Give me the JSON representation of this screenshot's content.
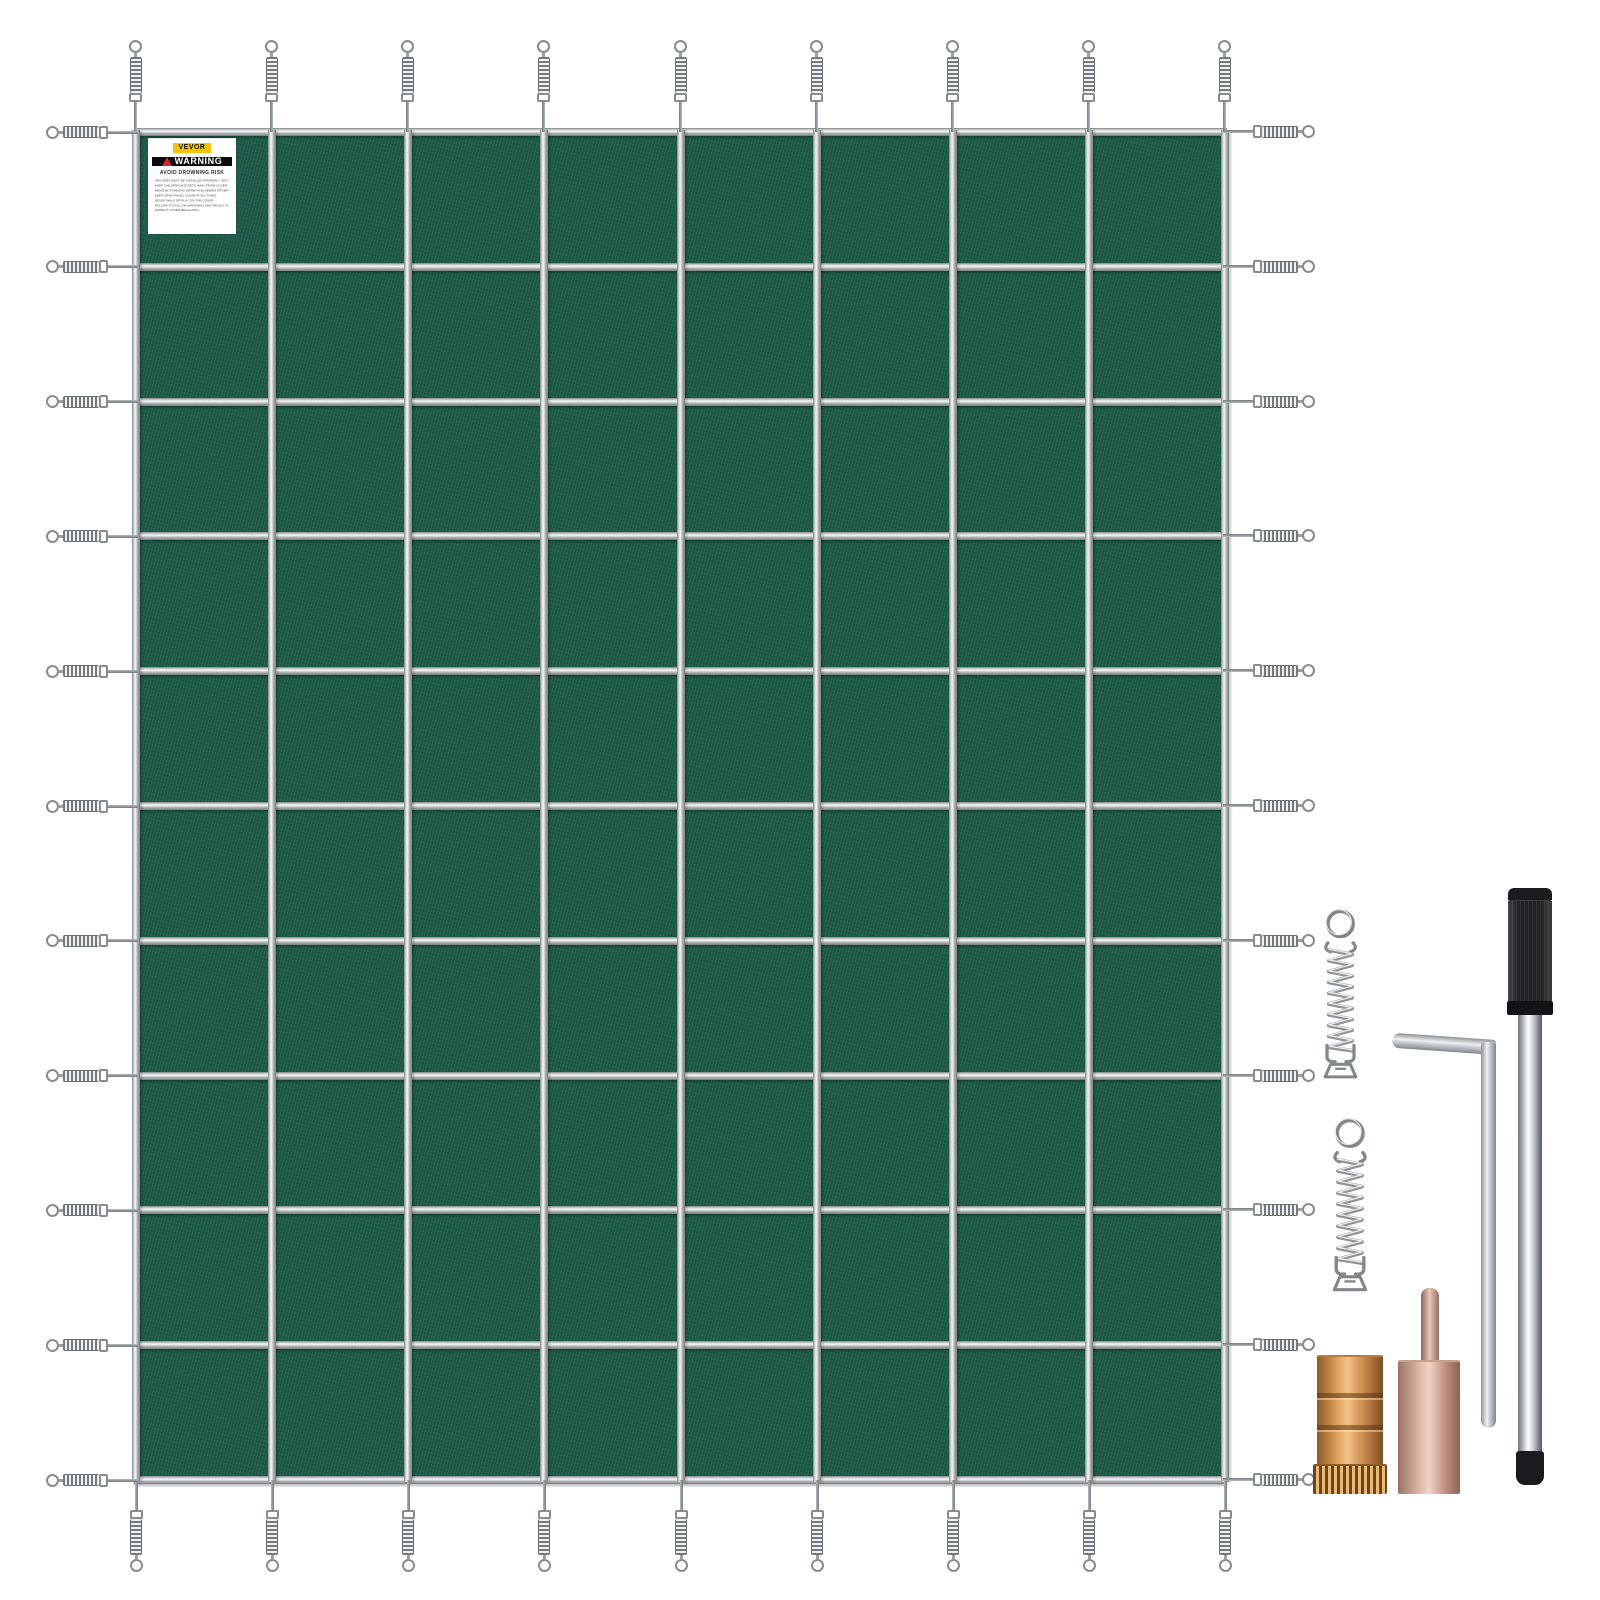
{
  "scene": {
    "description": "Green rectangular mesh swimming pool safety cover laid flat with stainless steel strap grid and perimeter spring fasteners, shown with installation hardware kit",
    "background": "#ffffff"
  },
  "cover": {
    "fabric_color": "#1d5a4a",
    "strap_color": "#c9cdd0",
    "vertical_straps": 9,
    "horizontal_straps": 11,
    "grid_columns": 8,
    "grid_rows": 10,
    "springs": {
      "top": 9,
      "bottom": 9,
      "left": 11,
      "right": 11,
      "total": 40
    }
  },
  "label": {
    "brand": "VEVOR",
    "warning_title": "WARNING",
    "warning_subtitle": "AVOID  DROWNING  RISK",
    "lines": [
      "ANCHORS MUST BE INSTALLED PROPERLY. SECURE COVER WELL BEFORE USE.",
      "KEEP CHILDREN AND PETS AWAY FROM COVER.",
      "REMOVE STANDING WATER AND DEBRIS PROMPTLY.",
      "KEEP DRAIN PANEL CLEAR AT ALL TIMES.",
      "NEVER WALK OR PLAY ON THE COVER.",
      "FAILURE TO FOLLOW WARNINGS MAY RESULT IN INJURY.",
      "INSPECT COVER REGULARLY."
    ]
  },
  "hardware": {
    "items": [
      {
        "name": "stainless-spring-fastener",
        "quantity_shown": 2
      },
      {
        "name": "hex-key",
        "quantity_shown": 1
      },
      {
        "name": "installation-rod",
        "quantity_shown": 1
      },
      {
        "name": "brass-anchor",
        "quantity_shown": 1
      },
      {
        "name": "anchor-tamping-tool",
        "quantity_shown": 1
      }
    ]
  },
  "colors": {
    "fabric": "#1d5a4a",
    "strap_silver": "#c9cdd0",
    "brand_yellow": "#f5c400",
    "warning_red": "#d2232a",
    "warning_bar_black": "#0c0c0c",
    "brass": "#d99a55",
    "rose_gold": "#d9b2a2",
    "chrome": "#eef1f3",
    "handle_black": "#212327"
  }
}
